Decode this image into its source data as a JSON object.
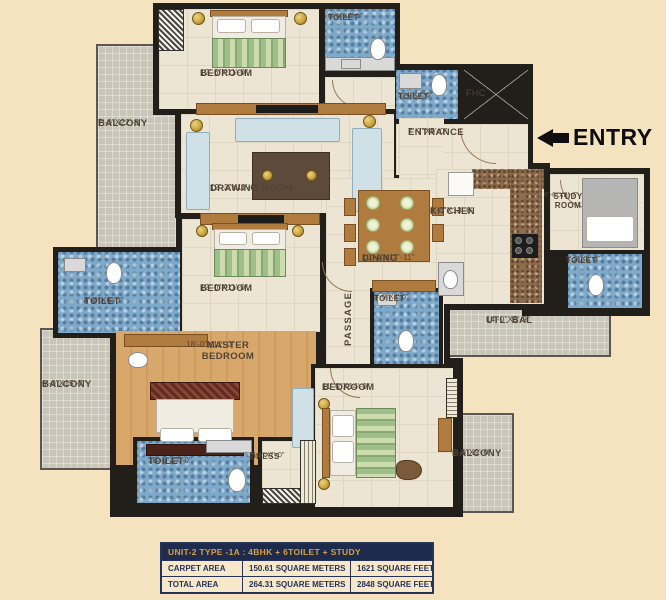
{
  "rooms": [
    {
      "id": "bedroom-top",
      "name": "BEDROOM",
      "dims": "12'-6\"X11'-0\""
    },
    {
      "id": "toilet-top",
      "name": "TOILET",
      "dims": "6'-0\"X7'-5\""
    },
    {
      "id": "toilet-entry",
      "name": "TOILET",
      "dims": "5'-4\"X4'-6\""
    },
    {
      "id": "fhc",
      "name": "FHC",
      "dims": ""
    },
    {
      "id": "entrance",
      "name": "ENTRANCE",
      "dims": "7'-7\"X5'-0\""
    },
    {
      "id": "balcony-top-left",
      "name": "BALCONY",
      "dims": "7'-0\"X22'-8\""
    },
    {
      "id": "drawing-room",
      "name": "DRAWING ROOM",
      "dims": "12'-3\"X11'-0\""
    },
    {
      "id": "bedroom-middle",
      "name": "BEDROOM",
      "dims": "12'-0\"X11'-0\""
    },
    {
      "id": "kitchen",
      "name": "KITCHEN",
      "dims": "8'-0\"X13'-6\""
    },
    {
      "id": "study-room",
      "name": "STUDY ROOM",
      "dims": "6'-6\"X8'-7\""
    },
    {
      "id": "toilet-study",
      "name": "TOILET",
      "dims": "3'-3\"X5'-3\""
    },
    {
      "id": "dining",
      "name": "DINING",
      "dims": "10'-4\"X17'-11\""
    },
    {
      "id": "toilet-left",
      "name": "TOILET",
      "dims": "8'-0\"X6'-0\""
    },
    {
      "id": "passage",
      "name": "PASSAGE",
      "dims": ""
    },
    {
      "id": "toilet-middle",
      "name": "TOILET",
      "dims": "6'-0\"X8'-0\""
    },
    {
      "id": "utility-balcony",
      "name": "UTL. BAL",
      "dims": "14'-0\"X5'-9\""
    },
    {
      "id": "balcony-bottom-left",
      "name": "BALCONY",
      "dims": "6'-0\"X15'-7\""
    },
    {
      "id": "master-bedroom",
      "name": "MASTER BEDROOM",
      "dims": "18'-0\"X12'-0\""
    },
    {
      "id": "bedroom-bottom",
      "name": "BEDROOM",
      "dims": "11'-0\"X14'-0\""
    },
    {
      "id": "toilet-master",
      "name": "TOILET",
      "dims": "10'-6\"X7'-0\""
    },
    {
      "id": "dress",
      "name": "DRESS",
      "dims": "5'-4\"X7'-0\""
    },
    {
      "id": "balcony-bottom-right",
      "name": "BALCONY",
      "dims": "5'-0\"X9'-0\""
    }
  ],
  "entry": {
    "label": "ENTRY"
  },
  "table": {
    "header": "UNIT-2 TYPE -1A : 4BHK + 6TOILET + STUDY",
    "rows": [
      {
        "label": "CARPET AREA",
        "meters": "150.61 SQUARE METERS",
        "feet": "1621 SQUARE FEET"
      },
      {
        "label": "TOTAL AREA",
        "meters": "264.31 SQUARE METERS",
        "feet": "2848 SQUARE FEET"
      }
    ]
  },
  "colors": {
    "background": "#f5e2bf",
    "wall": "#221e19",
    "toilet_floor": "#7fa9c9",
    "balcony_floor": "#c9c5b8",
    "wood_floor": "#d8a76c",
    "table_header_bg": "#1f2b4d",
    "table_gold": "#d9a13e",
    "table_navy": "#26325a"
  }
}
